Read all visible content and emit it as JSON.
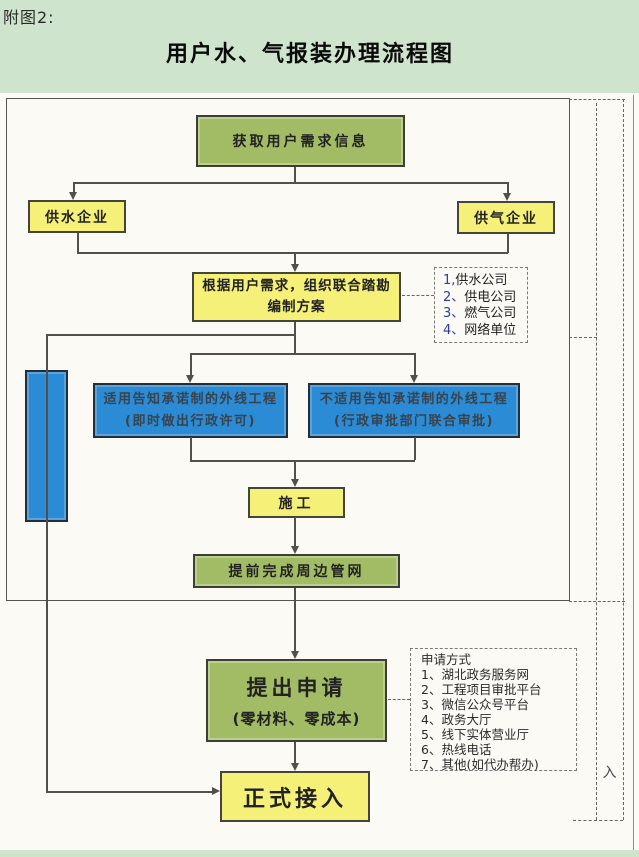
{
  "page": {
    "figure_label": "附图2:",
    "title": "用户水、气报装办理流程图",
    "access_char": "入"
  },
  "flow": {
    "acquire": "获取用户需求信息",
    "water_company": "供水企业",
    "gas_company": "供气企业",
    "plan_line1": "根据用户需求，组织联合踏勘",
    "plan_line2": "编制方案",
    "promise_line1": "适用告知承诺制的外线工程",
    "promise_line2": "(即时做出行政许可)",
    "no_promise_line1": "不适用告知承诺制的外线工程",
    "no_promise_line2": "(行政审批部门联合审批)",
    "construction": "施工",
    "pipeline_done": "提前完成周边管网",
    "apply_line1": "提出申请",
    "apply_line2": "(零材料、零成本)",
    "formal_connect": "正式接入"
  },
  "suppliers": {
    "items": [
      {
        "num": "1,",
        "name": "供水公司"
      },
      {
        "num": "2、",
        "name": "供电公司"
      },
      {
        "num": "3、",
        "name": "燃气公司"
      },
      {
        "num": "4、",
        "name": "网络单位"
      }
    ]
  },
  "apply_methods": {
    "heading": "申请方式",
    "items": [
      "1、湖北政务服务网",
      "2、工程项目审批平台",
      "3、微信公众号平台",
      "4、政务大厅",
      "5、线下实体营业厅",
      "6、热线电话",
      "7、其他(如代办帮办)"
    ]
  },
  "colors": {
    "page_bg": "#cee4cc",
    "panel_bg": "#fbfaf5",
    "green_box": "#a2bc66",
    "yellow_box": "#f5f078",
    "blue_box": "#2b8bd4",
    "line": "#50504c"
  }
}
